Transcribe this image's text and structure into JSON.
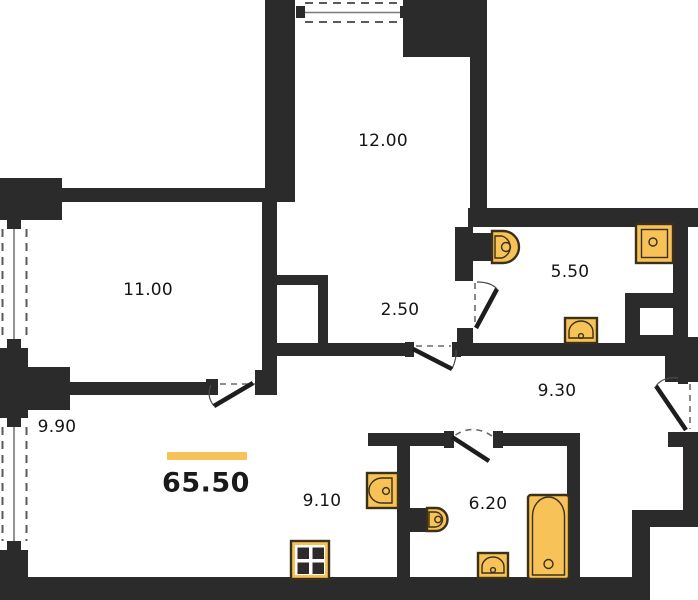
{
  "plan": {
    "total_area": "65.50",
    "rooms": [
      {
        "name": "room-upper",
        "area": "12.00"
      },
      {
        "name": "room-left",
        "area": "11.00"
      },
      {
        "name": "hall",
        "area": "2.50"
      },
      {
        "name": "bathroom",
        "area": "5.50"
      },
      {
        "name": "corridor",
        "area": "9.30"
      },
      {
        "name": "living-left",
        "area": "9.90"
      },
      {
        "name": "kitchen",
        "area": "9.10"
      },
      {
        "name": "wc",
        "area": "6.20"
      }
    ],
    "fixtures": [
      "toilet",
      "shower-tray",
      "washbasin",
      "kitchen-sink",
      "toilet",
      "washbasin",
      "bathtub",
      "stove"
    ],
    "colors": {
      "wall": "#2b2b2b",
      "fixture_fill": "#f7c257",
      "fixture_stroke": "#3a3118",
      "accent_bar": "#f7c257",
      "label_text": "#151515",
      "background": "#ffffff"
    }
  }
}
